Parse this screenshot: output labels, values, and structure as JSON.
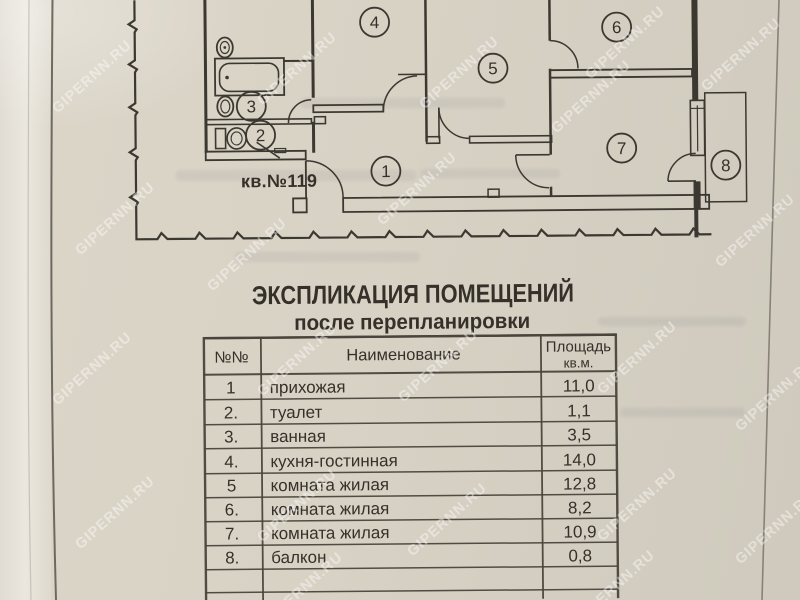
{
  "document": {
    "watermark_text": "GIPERNN.RU",
    "plan": {
      "apartment_label": "кв.№119",
      "rooms": [
        "1",
        "2",
        "3",
        "4",
        "5",
        "6",
        "7",
        "8"
      ]
    },
    "explication": {
      "title": "ЭКСПЛИКАЦИЯ ПОМЕЩЕНИЙ",
      "subtitle": "после перепланировки",
      "table": {
        "col_num": "№№",
        "col_name": "Наименование",
        "col_area_line1": "Площадь",
        "col_area_line2": "кв.м.",
        "rows": [
          {
            "num": "1",
            "name": "прихожая",
            "area": "11,0"
          },
          {
            "num": "2.",
            "name": "туалет",
            "area": "1,1"
          },
          {
            "num": "3.",
            "name": "ванная",
            "area": "3,5"
          },
          {
            "num": "4.",
            "name": "кухня-гостинная",
            "area": "14,0"
          },
          {
            "num": "5",
            "name": "комната жилая",
            "area": "12,8"
          },
          {
            "num": "6.",
            "name": "комната жилая",
            "area": "8,2"
          },
          {
            "num": "7.",
            "name": "комната жилая",
            "area": "10,9"
          },
          {
            "num": "8.",
            "name": "балкон",
            "area": "0,8"
          }
        ]
      }
    }
  }
}
